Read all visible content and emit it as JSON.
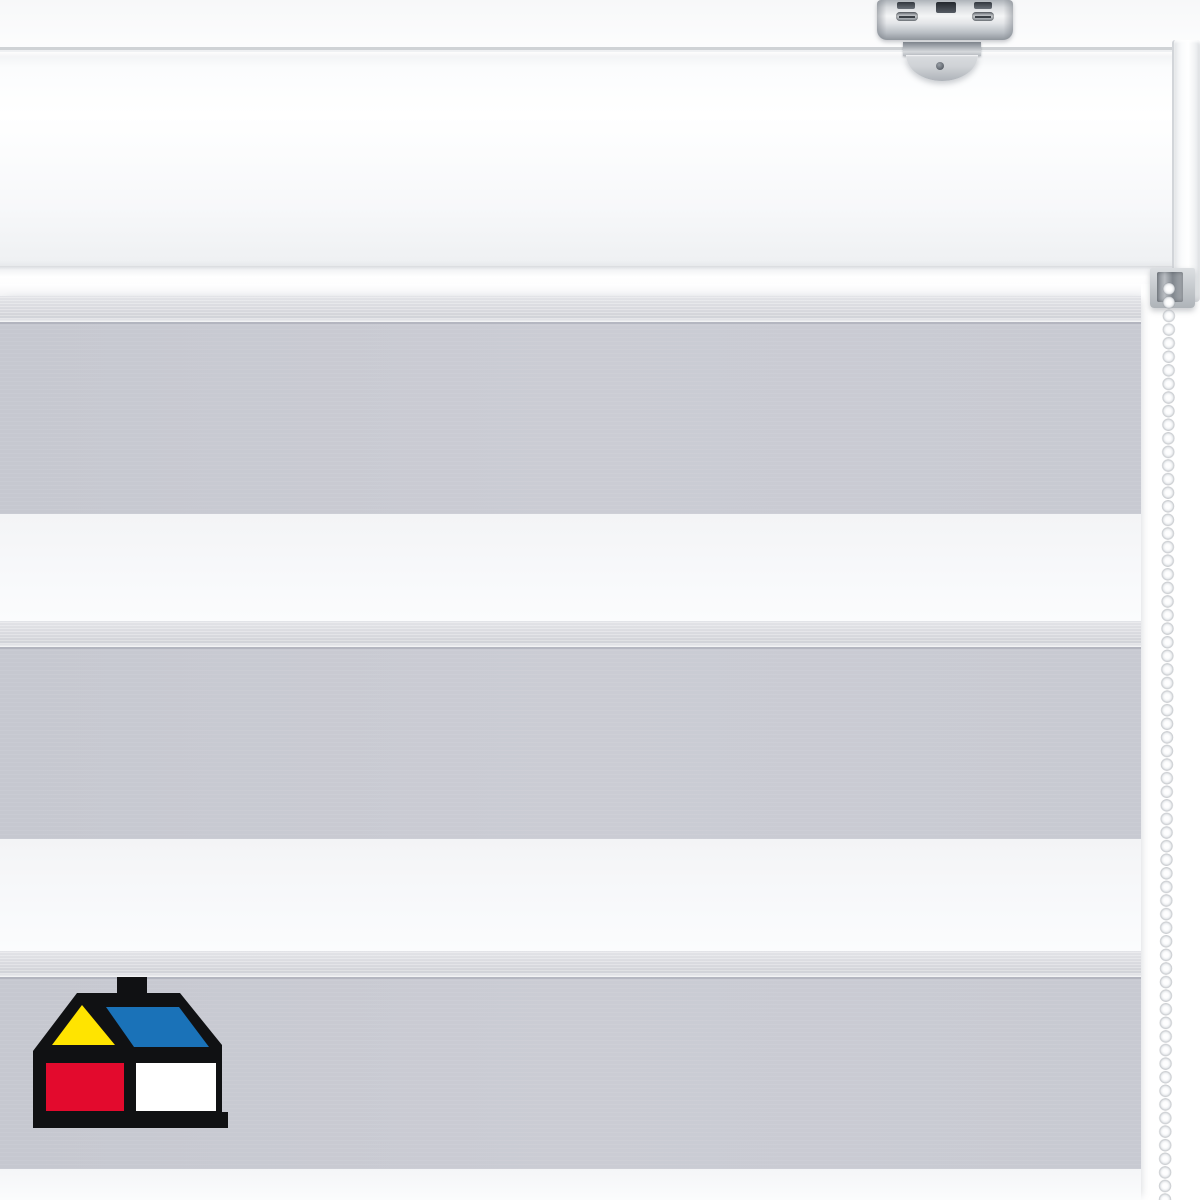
{
  "page": {
    "title": "Day/Night zebra roller blind product photo"
  },
  "product": {
    "kind": "day-night-dual-roller-blind",
    "fabric": "alternating grey and sheer-white horizontal stripes",
    "hardware": "white cassette headrail with metal ceiling-mount bracket and white bead pull chain"
  },
  "colors": {
    "background": "#ffffff",
    "rail_face": "#fafbfc",
    "rail_edge": "#cfd2d5",
    "band_gray": "#c9cbd3",
    "band_sheer": "#dadbe0",
    "band_white": "#f6f7f9",
    "bracket_metal": "#c9ccd1",
    "chain_bead": "#ffffff"
  },
  "blind": {
    "fabric": {
      "bands": [
        {
          "kind": "sheer"
        },
        {
          "kind": "gray"
        },
        {
          "kind": "white"
        },
        {
          "kind": "sheer"
        },
        {
          "kind": "gray"
        },
        {
          "kind": "white2"
        },
        {
          "kind": "sheer"
        },
        {
          "kind": "gray"
        },
        {
          "kind": "whiteEnd"
        }
      ]
    }
  },
  "logo": {
    "name": "sodimac-homecenter-house-logo",
    "black": "#101113",
    "yellow": "#ffe400",
    "blue": "#1a72b8",
    "red": "#e30a2d",
    "white": "#ffffff"
  }
}
